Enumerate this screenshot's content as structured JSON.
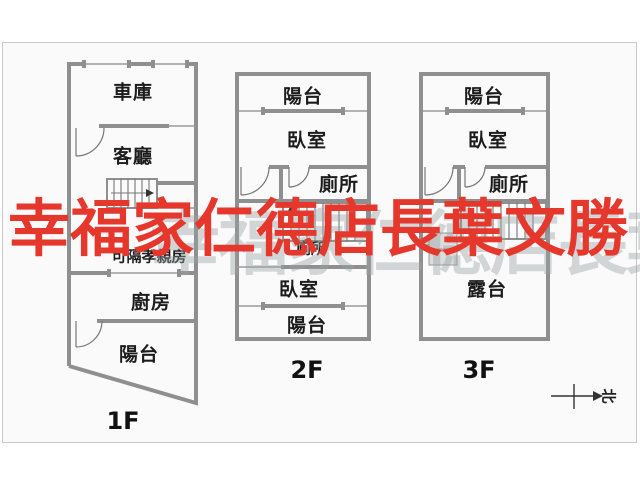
{
  "canvas": {
    "background": "#fafafa",
    "border_color": "#c9c9c9",
    "wall_color": "#8f8f8f"
  },
  "watermark": {
    "red_text": "幸福家仁德店長葉文勝",
    "red_color": "#e6372d",
    "gray_text": "幸福家仁德店長葉文勝",
    "gray_color": "#9aa3a3"
  },
  "compass": {
    "north_label": "北"
  },
  "floor_1f": {
    "label": "1F",
    "room_garage": "車庫",
    "room_living": "客廳",
    "room_flex": "可隔孝親房",
    "room_kitchen": "廚房",
    "room_balcony": "陽台"
  },
  "floor_2f": {
    "label": "2F",
    "room_balcony_top": "陽台",
    "room_bedroom_top": "臥室",
    "room_toilet_top": "廁所",
    "room_toilet_mid": "廁所",
    "room_bedroom_bottom": "臥室",
    "room_balcony_bottom": "陽台"
  },
  "floor_3f": {
    "label": "3F",
    "room_balcony": "陽台",
    "room_bedroom": "臥室",
    "room_toilet": "廁所",
    "room_terrace": "露台"
  }
}
